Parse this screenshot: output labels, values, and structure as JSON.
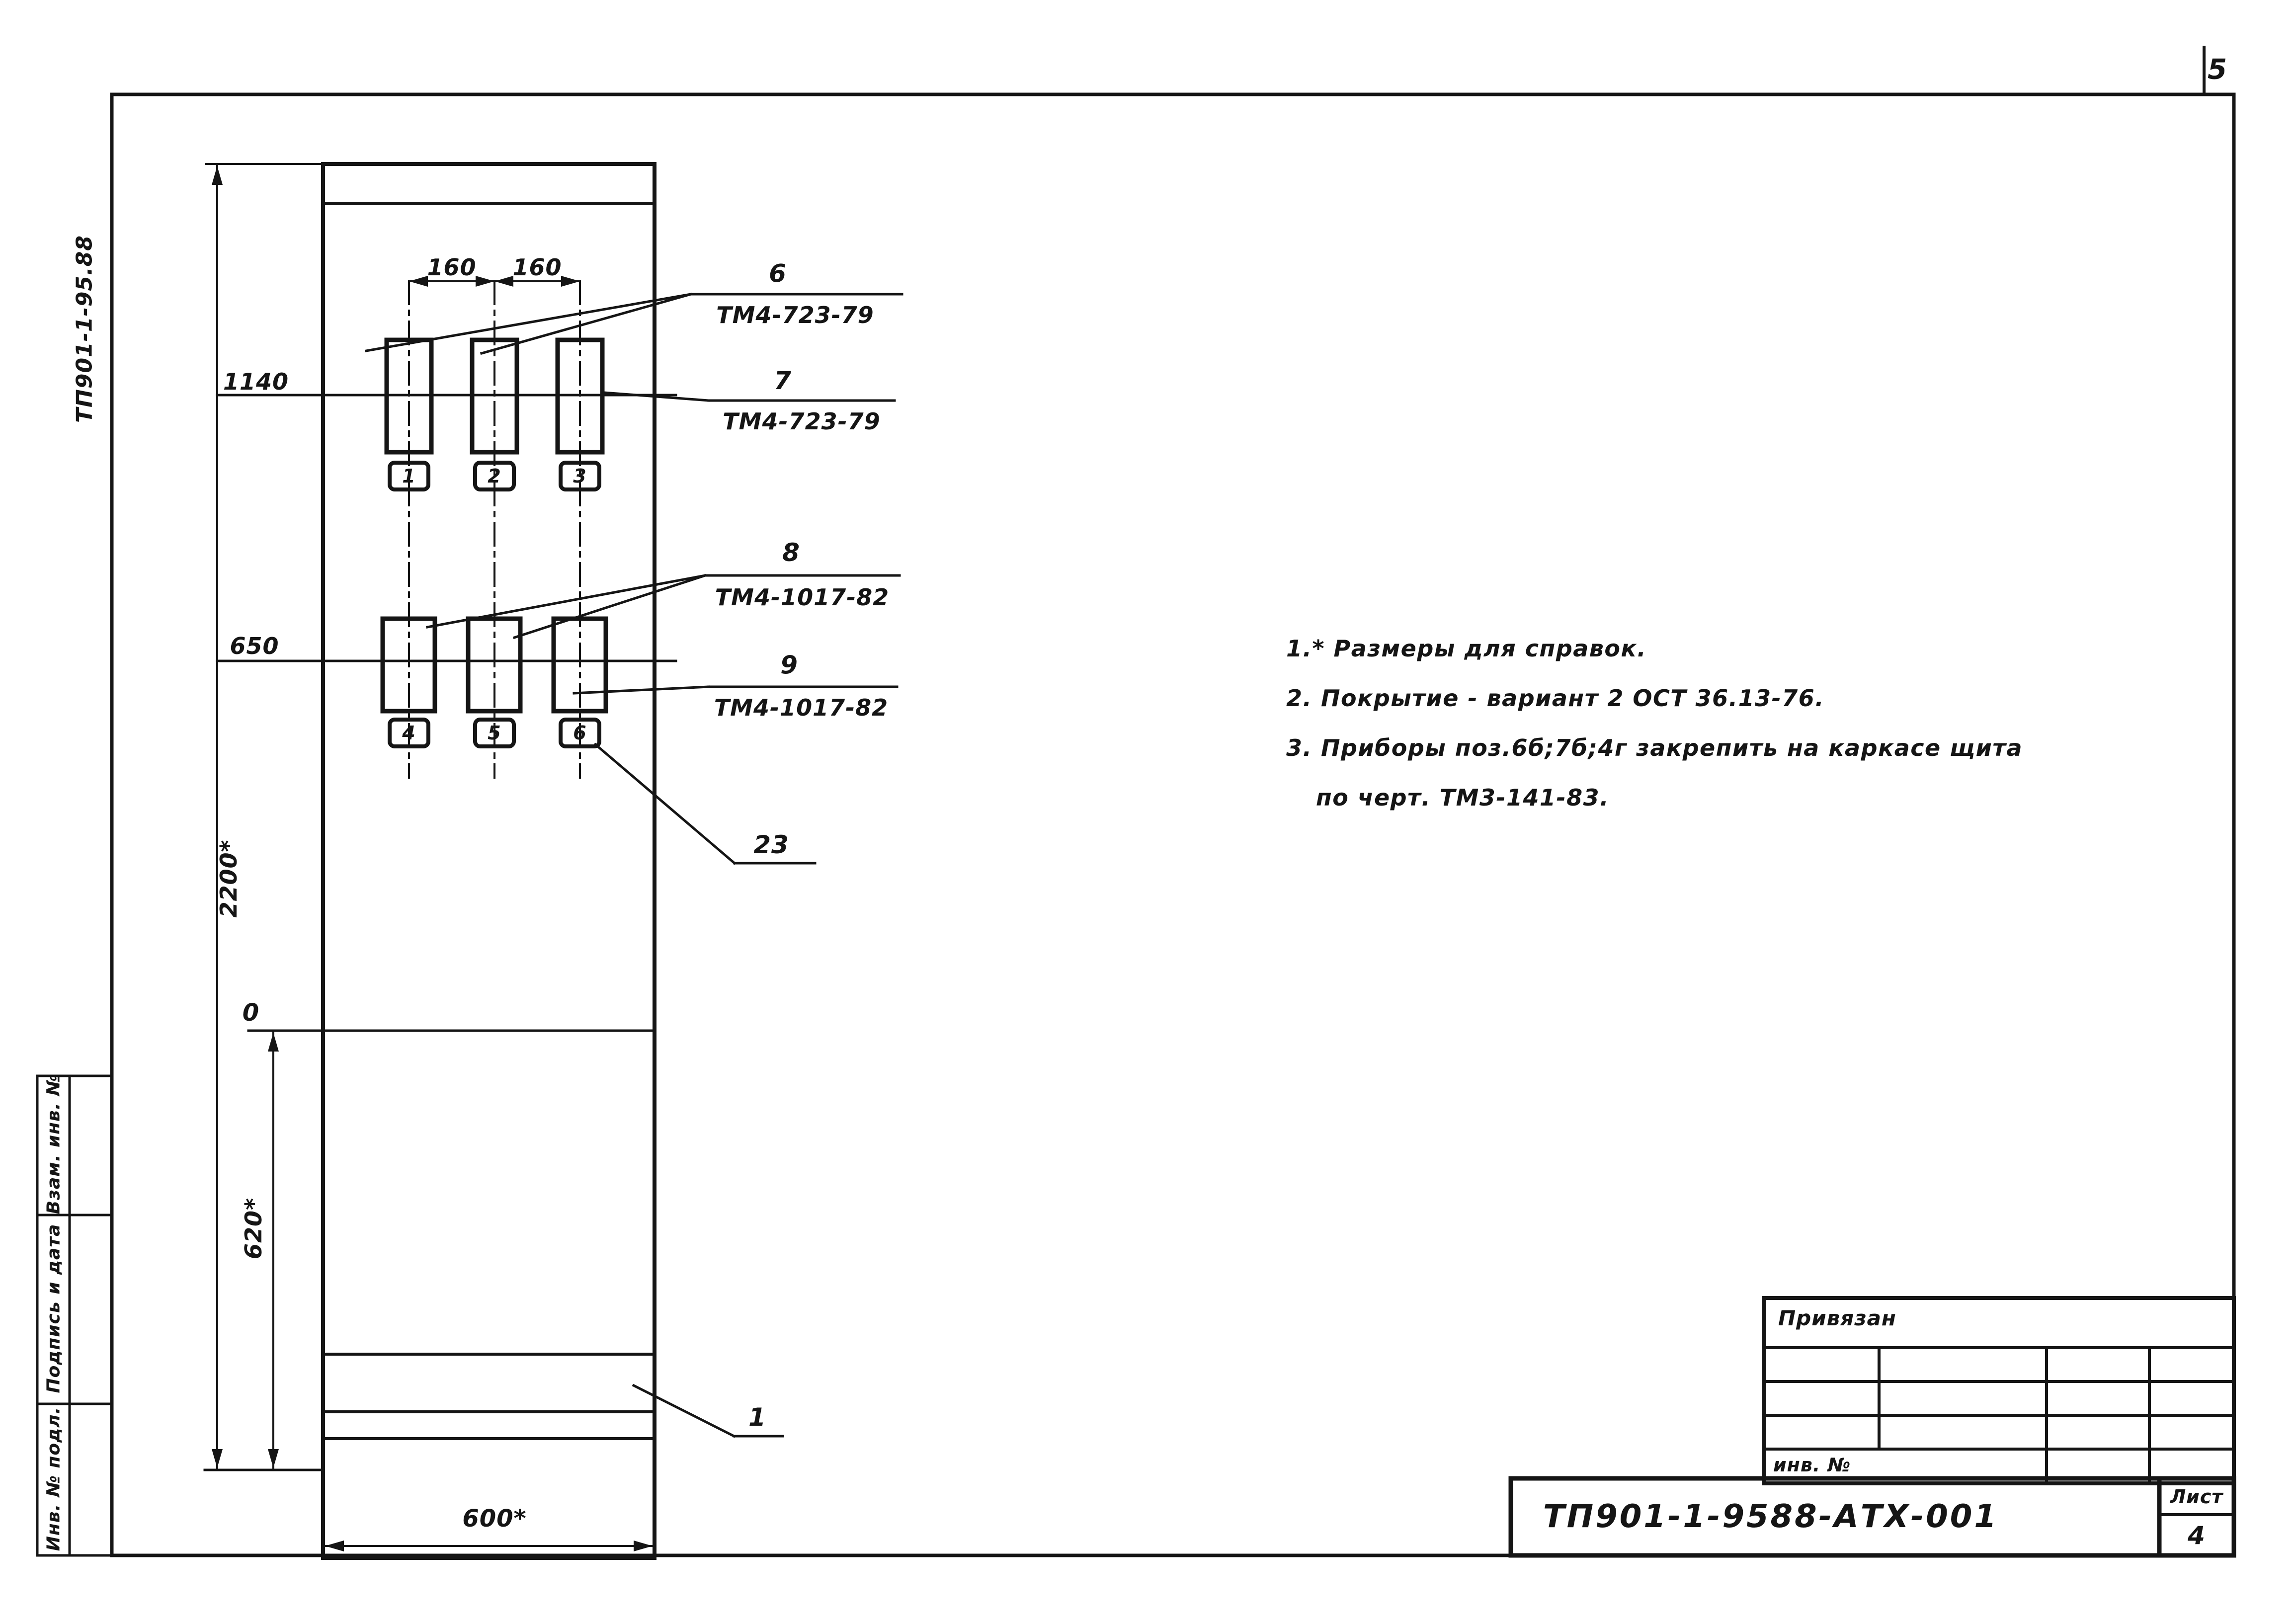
{
  "page": {
    "corner_sheet_number": "5"
  },
  "margin": {
    "doc_code_vertical": "ТП901-1-95.88",
    "stamp_rows": [
      {
        "label": "Взам. инв. №"
      },
      {
        "label": "Подпись и дата"
      },
      {
        "label": "Инв. № подл."
      }
    ]
  },
  "drawing": {
    "dimensions": {
      "d160a": "160",
      "d160b": "160",
      "d1140": "1140",
      "d650": "650",
      "d0": "0",
      "d620": "620*",
      "d2200": "2200*",
      "d600": "600*"
    },
    "instrument_tags": [
      "1",
      "2",
      "3",
      "4",
      "5",
      "6"
    ],
    "callouts": [
      {
        "num": "6",
        "doc": "ТМ4-723-79"
      },
      {
        "num": "7",
        "doc": "ТМ4-723-79"
      },
      {
        "num": "8",
        "doc": "ТМ4-1017-82"
      },
      {
        "num": "9",
        "doc": "ТМ4-1017-82"
      },
      {
        "num": "23",
        "doc": ""
      },
      {
        "num": "1",
        "doc": ""
      }
    ]
  },
  "notes": {
    "line1": "1.* Размеры  для  справок.",
    "line2": "2. Покрытие - вариант 2 ОСТ 36.13-76.",
    "line3": "3. Приборы поз.6б;7б;4г закрепить  на  каркасе  щита",
    "line4": "по черт.  ТМ3-141-83."
  },
  "title_block": {
    "linked_label": "Привязан",
    "inv_label": "инв. №",
    "doc_number": "ТП901-1-9588-АТХ-001",
    "sheet_label": "Лист",
    "sheet_number": "4"
  },
  "colors": {
    "ink": "#151515",
    "paper": "#ffffff"
  }
}
